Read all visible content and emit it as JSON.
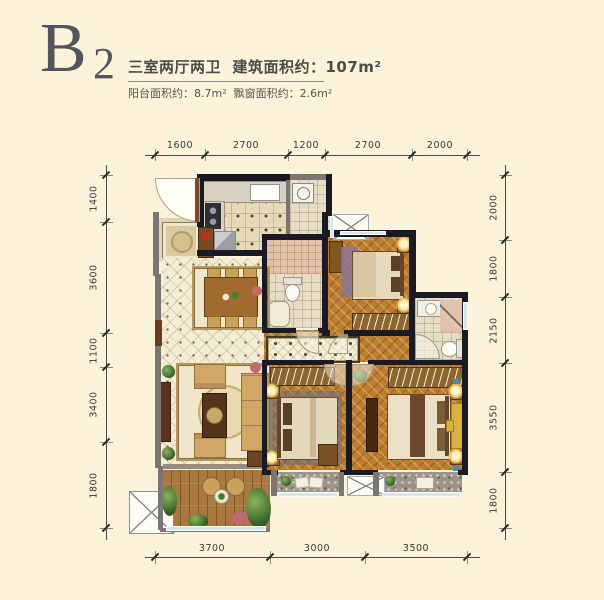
{
  "title": {
    "code_letter": "B",
    "code_number": "2",
    "summary": "三室两厅两卫  建筑面积约：107m²",
    "sub_info": "阳台面积约：8.7m²  飘窗面积约：2.6m²"
  },
  "dimensions_mm": {
    "top": [
      "1600",
      "2700",
      "1200",
      "2700",
      "2000"
    ],
    "left": [
      "1400",
      "3600",
      "1100",
      "3400",
      "1800"
    ],
    "right": [
      "2000",
      "1800",
      "2150",
      "3550",
      "1800"
    ],
    "bottom": [
      "3700",
      "3000",
      "3500"
    ]
  },
  "colors": {
    "background": "#fcf3da",
    "wall_primary": "#1a1a24",
    "wall_secondary": "#7b7672",
    "wood_floor": "#bd7d2f",
    "tile_floor": "#f3edd6",
    "window_glass": "#d6e7ec",
    "title_text": "#55555e"
  },
  "rooms": [
    "entry-foyer",
    "kitchen",
    "laundry-room",
    "shared-bathroom",
    "north-bedroom",
    "master-bathroom",
    "dining-area",
    "living-room",
    "hallway",
    "second-bedroom",
    "master-bedroom",
    "balcony",
    "bay-window-second",
    "bay-window-master",
    "ac-platform-top",
    "ac-platform-west",
    "ac-platform-south"
  ]
}
